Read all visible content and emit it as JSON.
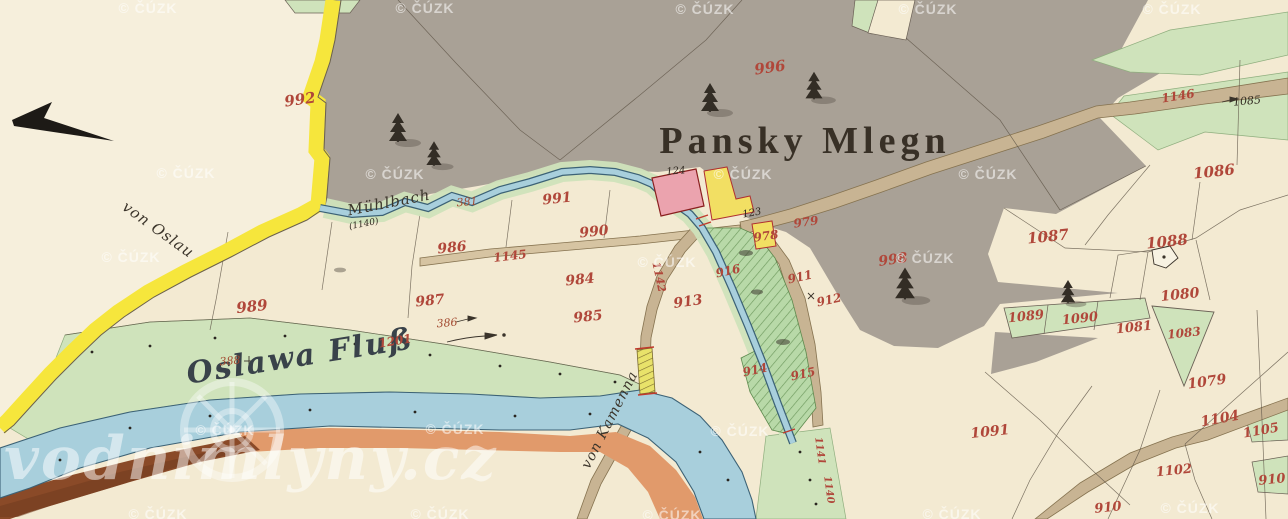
{
  "title": {
    "text": "Pansky Mlegn"
  },
  "brand": {
    "text": "vodnimlyny.cz"
  },
  "watermarks": {
    "text": "© ČÚZK",
    "positions": [
      [
        148,
        8
      ],
      [
        425,
        8
      ],
      [
        705,
        9
      ],
      [
        928,
        9
      ],
      [
        1172,
        9
      ],
      [
        186,
        173
      ],
      [
        395,
        174
      ],
      [
        743,
        174
      ],
      [
        988,
        174
      ],
      [
        131,
        257
      ],
      [
        667,
        262
      ],
      [
        925,
        258
      ],
      [
        225,
        430
      ],
      [
        455,
        429
      ],
      [
        740,
        431
      ],
      [
        158,
        514
      ],
      [
        440,
        514
      ],
      [
        672,
        515
      ],
      [
        952,
        514
      ],
      [
        1190,
        508
      ]
    ]
  },
  "labels": [
    {
      "t": "von Oslau",
      "x": 158,
      "y": 230,
      "s": 15,
      "r": 36,
      "c": "place"
    },
    {
      "t": "Mühlbach",
      "x": 389,
      "y": 203,
      "s": 15,
      "r": -11,
      "c": "place"
    },
    {
      "t": "(1140)",
      "x": 364,
      "y": 225,
      "s": 9,
      "r": -11,
      "c": "blk"
    },
    {
      "t": "Oslawa Fluß",
      "x": 300,
      "y": 357,
      "s": 30,
      "r": -9,
      "c": "water"
    },
    {
      "t": "von Kamenna",
      "x": 610,
      "y": 420,
      "s": 14,
      "r": -63,
      "c": "place"
    },
    {
      "t": "992",
      "x": 300,
      "y": 100,
      "s": 15,
      "r": -8,
      "c": "red"
    },
    {
      "t": "996",
      "x": 770,
      "y": 68,
      "s": 15,
      "r": -8,
      "c": "red"
    },
    {
      "t": "998",
      "x": 893,
      "y": 260,
      "s": 14,
      "r": -8,
      "c": "red"
    },
    {
      "t": "989",
      "x": 252,
      "y": 307,
      "s": 15,
      "r": -6,
      "c": "red"
    },
    {
      "t": "987",
      "x": 430,
      "y": 301,
      "s": 14,
      "r": -6,
      "c": "red"
    },
    {
      "t": "986",
      "x": 452,
      "y": 248,
      "s": 14,
      "r": -6,
      "c": "red"
    },
    {
      "t": "990",
      "x": 594,
      "y": 232,
      "s": 14,
      "r": -6,
      "c": "red"
    },
    {
      "t": "991",
      "x": 557,
      "y": 199,
      "s": 14,
      "r": -6,
      "c": "red"
    },
    {
      "t": "984",
      "x": 580,
      "y": 280,
      "s": 14,
      "r": -6,
      "c": "red"
    },
    {
      "t": "985",
      "x": 588,
      "y": 317,
      "s": 14,
      "r": -6,
      "c": "red"
    },
    {
      "t": "978",
      "x": 766,
      "y": 236,
      "s": 12,
      "r": -8,
      "c": "red"
    },
    {
      "t": "979",
      "x": 806,
      "y": 222,
      "s": 12,
      "r": -8,
      "c": "red"
    },
    {
      "t": "913",
      "x": 688,
      "y": 302,
      "s": 14,
      "r": -8,
      "c": "red"
    },
    {
      "t": "916",
      "x": 728,
      "y": 271,
      "s": 12,
      "r": -12,
      "c": "red"
    },
    {
      "t": "911",
      "x": 800,
      "y": 277,
      "s": 12,
      "r": -12,
      "c": "red"
    },
    {
      "t": "912",
      "x": 829,
      "y": 300,
      "s": 12,
      "r": -12,
      "c": "red"
    },
    {
      "t": "914",
      "x": 755,
      "y": 370,
      "s": 12,
      "r": -12,
      "c": "red"
    },
    {
      "t": "915",
      "x": 803,
      "y": 374,
      "s": 12,
      "r": -12,
      "c": "red"
    },
    {
      "t": "1201",
      "x": 395,
      "y": 341,
      "s": 12,
      "r": -9,
      "c": "red"
    },
    {
      "t": "1091",
      "x": 990,
      "y": 432,
      "s": 14,
      "r": -6,
      "c": "red"
    },
    {
      "t": "1086",
      "x": 1214,
      "y": 172,
      "s": 15,
      "r": -6,
      "c": "red"
    },
    {
      "t": "1087",
      "x": 1048,
      "y": 237,
      "s": 15,
      "r": -6,
      "c": "red"
    },
    {
      "t": "1088",
      "x": 1167,
      "y": 242,
      "s": 15,
      "r": -6,
      "c": "red"
    },
    {
      "t": "1080",
      "x": 1180,
      "y": 295,
      "s": 14,
      "r": -6,
      "c": "red"
    },
    {
      "t": "1089",
      "x": 1026,
      "y": 317,
      "s": 13,
      "r": -6,
      "c": "red"
    },
    {
      "t": "1090",
      "x": 1080,
      "y": 319,
      "s": 13,
      "r": -6,
      "c": "red"
    },
    {
      "t": "1081",
      "x": 1134,
      "y": 328,
      "s": 13,
      "r": -6,
      "c": "red"
    },
    {
      "t": "1083",
      "x": 1184,
      "y": 333,
      "s": 12,
      "r": -6,
      "c": "red"
    },
    {
      "t": "1079",
      "x": 1207,
      "y": 382,
      "s": 14,
      "r": -8,
      "c": "red"
    },
    {
      "t": "1104",
      "x": 1220,
      "y": 419,
      "s": 14,
      "r": -10,
      "c": "red"
    },
    {
      "t": "1105",
      "x": 1261,
      "y": 431,
      "s": 13,
      "r": -10,
      "c": "red"
    },
    {
      "t": "1102",
      "x": 1174,
      "y": 471,
      "s": 13,
      "r": -6,
      "c": "red"
    },
    {
      "t": "910",
      "x": 1272,
      "y": 480,
      "s": 13,
      "r": -6,
      "c": "red"
    },
    {
      "t": "910",
      "x": 1108,
      "y": 508,
      "s": 13,
      "r": -6,
      "c": "red"
    },
    {
      "t": "1146",
      "x": 1178,
      "y": 96,
      "s": 12,
      "r": -9,
      "c": "road"
    },
    {
      "t": "1145",
      "x": 510,
      "y": 256,
      "s": 12,
      "r": -7,
      "c": "road"
    },
    {
      "t": "1142",
      "x": 659,
      "y": 277,
      "s": 11,
      "r": 78,
      "c": "road"
    },
    {
      "t": "1141",
      "x": 819,
      "y": 451,
      "s": 10,
      "r": 82,
      "c": "road"
    },
    {
      "t": "1140",
      "x": 828,
      "y": 490,
      "s": 10,
      "r": 82,
      "c": "road"
    },
    {
      "t": "381",
      "x": 467,
      "y": 202,
      "s": 11,
      "r": -5,
      "c": "survey"
    },
    {
      "t": "386",
      "x": 447,
      "y": 323,
      "s": 11,
      "r": -5,
      "c": "survey"
    },
    {
      "t": "388",
      "x": 230,
      "y": 361,
      "s": 11,
      "r": -5,
      "c": "survey"
    },
    {
      "t": "1085",
      "x": 1247,
      "y": 101,
      "s": 11,
      "r": -5,
      "c": "blk"
    },
    {
      "t": "123",
      "x": 752,
      "y": 214,
      "s": 10,
      "r": -10,
      "c": "blk"
    },
    {
      "t": "124",
      "x": 676,
      "y": 172,
      "s": 10,
      "r": -5,
      "c": "blk"
    }
  ],
  "palette": {
    "paper": "#f3ead2",
    "neighbor_paper": "#f6efdc",
    "boundary_yellow": "#f6e63c",
    "pasture_gray": "#a9a196",
    "meadow_green": "#cfe3bb",
    "garden_green": "#b8d9a8",
    "hatch_green": "#6f9a5f",
    "water_blue": "#a8cfdc",
    "water_edge": "#3c6276",
    "bank_orange": "#e19a6b",
    "bank_brown": "#8a4a28",
    "road_tan": "#c8b493",
    "building_wood": "#f2df63",
    "building_masonry": "#eba3ae",
    "building_outline_red": "#b03030",
    "ink_red": "#b0473a",
    "ink_black": "#322b22",
    "watermark_white": "#ffffff"
  }
}
